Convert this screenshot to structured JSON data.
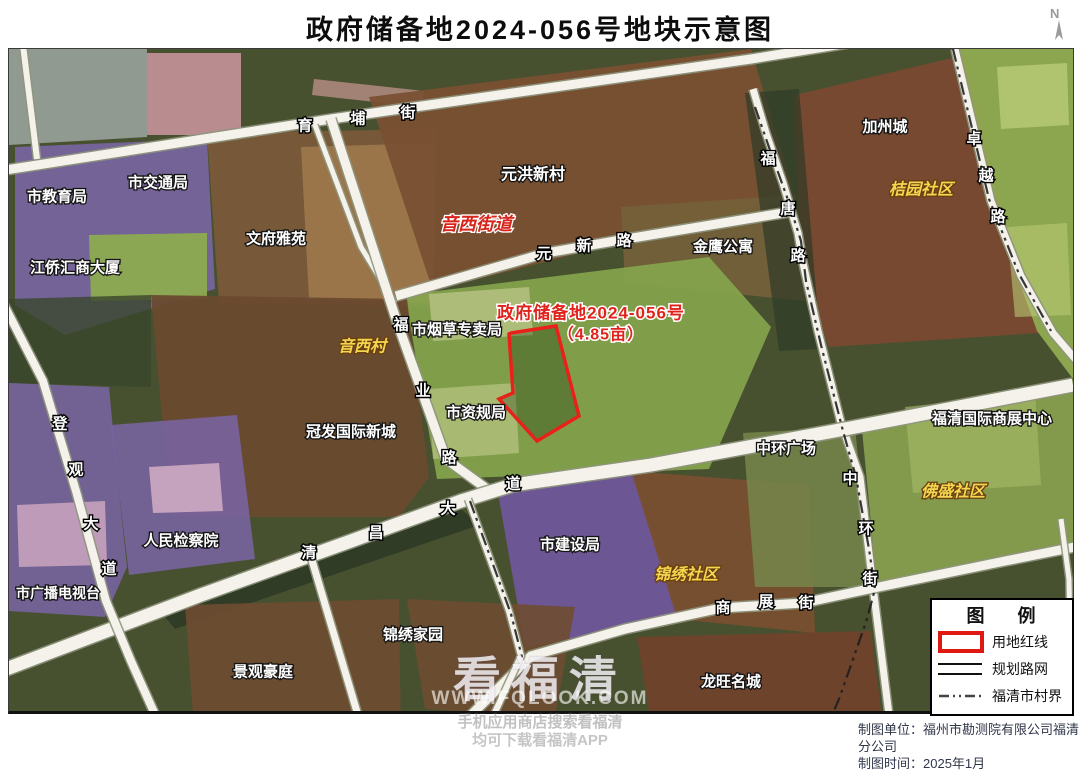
{
  "title": "政府储备地2024-056号地块示意图",
  "north_label": "N",
  "parcel": {
    "name": "政府储备地2024-056号",
    "area_label": "（4.85亩）",
    "area_mu": "4.85",
    "outline_color": "#e8211a"
  },
  "legend": {
    "title": "图 例",
    "items": [
      {
        "type": "red-rect",
        "label": "用地红线"
      },
      {
        "type": "double-line",
        "label": "规划路网"
      },
      {
        "type": "dash-dot",
        "label": "福清市村界"
      }
    ]
  },
  "credits": {
    "unit": "制图单位：福州市勘测院有限公司福清分公司",
    "date": "制图时间：2025年1月"
  },
  "watermark": {
    "brand": "看福清",
    "url": "WWW.FQLOOK.COM",
    "line1": "手机应用商店搜索看福清",
    "line2": "均可下载看福清APP"
  },
  "colors": {
    "road": "#f4f2ea",
    "road_casing": "#8f957e",
    "boundary": "#1c1c1c",
    "parcel_red": "#e8211a",
    "label_white": "#ffffff",
    "label_yellow": "#f4d64f",
    "label_red": "#d8251c",
    "base_green": "#47512f"
  },
  "map": {
    "regions": [
      {
        "name": "topleft-grey",
        "fill": "#99a29b",
        "opacity": 0.9,
        "points": "0,0 138,0 138,88 0,96"
      },
      {
        "name": "track-field",
        "fill": "#c08f96",
        "opacity": 0.95,
        "points": "138,4 232,4 232,86 138,86"
      },
      {
        "name": "pink-strip",
        "fill": "#b98e86",
        "opacity": 0.8,
        "points": "305,30 415,42 412,58 303,46"
      },
      {
        "name": "edu-purple",
        "fill": "#7b65a5",
        "opacity": 0.88,
        "points": "6,98 198,90 206,240 56,286 6,256"
      },
      {
        "name": "edu-green",
        "fill": "#8cab50",
        "opacity": 0.95,
        "points": "80,186 198,184 198,250 82,252"
      },
      {
        "name": "jiaotong-brown",
        "fill": "#7c5a3b",
        "opacity": 0.92,
        "points": "198,84 428,80 424,258 210,254"
      },
      {
        "name": "wenfu-tan",
        "fill": "#a07a4e",
        "opacity": 0.85,
        "points": "292,98 426,94 424,254 300,250"
      },
      {
        "name": "yuanhong-brown",
        "fill": "#7a5033",
        "opacity": 0.95,
        "points": "360,48 742,0 786,148 424,242"
      },
      {
        "name": "jinying-area",
        "fill": "#74603a",
        "opacity": 0.9,
        "points": "612,158 786,146 796,252 616,234"
      },
      {
        "name": "jiazhou-brown",
        "fill": "#7a4931",
        "opacity": 0.95,
        "points": "786,46 956,6 1004,198 1030,284 820,298 790,214"
      },
      {
        "name": "right-green",
        "fill": "#93ad53",
        "opacity": 0.92,
        "points": "950,0 1064,0 1064,330 1028,282 984,158"
      },
      {
        "name": "right-green-light1",
        "fill": "#b9ca75",
        "opacity": 0.8,
        "points": "988,18 1058,14 1060,76 992,80"
      },
      {
        "name": "right-green-light2",
        "fill": "#b9ca75",
        "opacity": 0.6,
        "points": "998,178 1058,174 1062,266 1006,268"
      },
      {
        "name": "center-green",
        "fill": "#86a54d",
        "opacity": 0.92,
        "points": "396,246 700,208 762,278 700,420 428,430"
      },
      {
        "name": "tobacco-building",
        "fill": "#b5c180",
        "opacity": 0.85,
        "points": "420,245 520,238 524,286 424,292"
      },
      {
        "name": "zigui-building",
        "fill": "#b5c180",
        "opacity": 0.75,
        "points": "420,340 506,334 510,404 424,410"
      },
      {
        "name": "yinxi-brown",
        "fill": "#6a4a2f",
        "opacity": 0.95,
        "points": "142,246 398,250 420,428 390,468 162,468"
      },
      {
        "name": "treeband-left",
        "fill": "#3a462c",
        "opacity": 0.8,
        "points": "0,250 142,246 142,338 0,334"
      },
      {
        "name": "treeband-futang",
        "fill": "#2f3b26",
        "opacity": 0.7,
        "points": "736,44 790,40 812,300 770,302"
      },
      {
        "name": "water-strip",
        "fill": "#2d3a25",
        "opacity": 0.9,
        "points": "148,558 452,460 470,476 166,580"
      },
      {
        "name": "broadcast-purple",
        "fill": "#7a64a4",
        "opacity": 0.85,
        "points": "0,334 100,338 108,424 118,518 96,568 0,562"
      },
      {
        "name": "broadcast-building",
        "fill": "#c7a2bc",
        "opacity": 0.9,
        "points": "8,456 96,452 98,516 10,518"
      },
      {
        "name": "procuratorate-purple",
        "fill": "#7a64a4",
        "opacity": 0.85,
        "points": "102,376 228,366 246,510 120,526"
      },
      {
        "name": "procuratorate-bldg",
        "fill": "#c9a6c0",
        "opacity": 0.95,
        "points": "140,418 210,414 214,462 144,464"
      },
      {
        "name": "construction-purple",
        "fill": "#7157a0",
        "opacity": 0.9,
        "points": "488,438 622,418 670,570 516,598"
      },
      {
        "name": "jinxiushequ-brown",
        "fill": "#7a4f30",
        "opacity": 0.9,
        "points": "622,422 800,436 806,584 668,570"
      },
      {
        "name": "zhonghuan-olive",
        "fill": "#76864a",
        "opacity": 0.85,
        "points": "734,384 846,378 862,538 746,538"
      },
      {
        "name": "rightbottom-green",
        "fill": "#89a150",
        "opacity": 0.92,
        "points": "852,370 1064,330 1064,496 868,538"
      },
      {
        "name": "rightbottom-light",
        "fill": "#a7bc67",
        "opacity": 0.6,
        "points": "896,358 1026,344 1032,436 904,444"
      },
      {
        "name": "jingguan-brown",
        "fill": "#6e4c31",
        "opacity": 0.92,
        "points": "176,556 390,550 392,700 186,694"
      },
      {
        "name": "jinxiujiayuan-brown",
        "fill": "#6e4c31",
        "opacity": 0.9,
        "points": "398,550 566,558 546,668 416,660"
      },
      {
        "name": "longwang-brown",
        "fill": "#72422c",
        "opacity": 0.92,
        "points": "628,588 862,582 872,662 640,662"
      }
    ],
    "roads": [
      {
        "name": "yupu-street",
        "width": 9,
        "points": "-10,122 322,70 742,10 840,-6"
      },
      {
        "name": "left-lane",
        "width": 6,
        "points": "14,-4 28,110"
      },
      {
        "name": "wenfu-lane",
        "width": 5,
        "points": "306,76 352,198 386,254"
      },
      {
        "name": "fuye-road",
        "width": 9,
        "points": "322,70 387,270 437,410 478,440"
      },
      {
        "name": "yuanxin-road",
        "width": 9,
        "points": "387,247 537,204 617,190 786,162"
      },
      {
        "name": "futang-zhonghuan",
        "width": 7,
        "points": "744,40 757,84 774,134 789,184 794,214 809,282 832,374 851,428 864,538 874,618 880,666"
      },
      {
        "name": "zhuoyue-road",
        "width": 7,
        "points": "946,0 982,152 1012,227 1044,284 1068,312"
      },
      {
        "name": "qingchang-avenue",
        "width": 13,
        "points": "-8,622 192,546 342,492 452,452 504,436 642,416 836,380 1064,336"
      },
      {
        "name": "shangzhan-street",
        "width": 9,
        "points": "370,710 460,668 522,607 616,580 712,559 794,554 860,540 996,512 1066,498"
      },
      {
        "name": "dengguan-avenue",
        "width": 8,
        "points": "-8,250 34,332 67,442 97,552 122,612 166,710"
      },
      {
        "name": "south-lane",
        "width": 7,
        "points": "302,508 362,710"
      },
      {
        "name": "center-south-lane",
        "width": 6,
        "points": "459,450 500,562 512,607 482,672 462,710"
      },
      {
        "name": "corner-lane",
        "width": 5,
        "points": "1052,470 1060,530 1062,662"
      }
    ],
    "boundaries": [
      {
        "name": "village-boundary-east",
        "points": "746,58 762,104 778,148 792,192 797,232 812,296 834,382 847,428 860,500 866,540 858,570 842,616 830,650 824,664"
      },
      {
        "name": "village-boundary-center",
        "points": "461,452 502,565 514,612"
      },
      {
        "name": "village-boundary-zhuoyue",
        "points": "944,0 980,150 1010,225 1042,282"
      }
    ],
    "road_labels": [
      {
        "road": "育埔街",
        "chars": [
          {
            "c": "育",
            "x": 296,
            "y": 77
          },
          {
            "c": "埔",
            "x": 349,
            "y": 70
          },
          {
            "c": "街",
            "x": 399,
            "y": 64
          }
        ]
      },
      {
        "road": "元新路",
        "chars": [
          {
            "c": "元",
            "x": 535,
            "y": 205
          },
          {
            "c": "新",
            "x": 575,
            "y": 197
          },
          {
            "c": "路",
            "x": 615,
            "y": 192
          }
        ]
      },
      {
        "road": "福业路",
        "chars": [
          {
            "c": "福",
            "x": 392,
            "y": 276
          },
          {
            "c": "业",
            "x": 414,
            "y": 342
          },
          {
            "c": "路",
            "x": 440,
            "y": 409
          }
        ]
      },
      {
        "road": "清昌大道",
        "chars": [
          {
            "c": "清",
            "x": 300,
            "y": 504
          },
          {
            "c": "昌",
            "x": 367,
            "y": 484
          },
          {
            "c": "大",
            "x": 439,
            "y": 460
          },
          {
            "c": "道",
            "x": 504,
            "y": 435
          }
        ]
      },
      {
        "road": "福唐路",
        "chars": [
          {
            "c": "福",
            "x": 759,
            "y": 110
          },
          {
            "c": "唐",
            "x": 779,
            "y": 160
          },
          {
            "c": "路",
            "x": 789,
            "y": 207
          }
        ]
      },
      {
        "road": "卓越路",
        "chars": [
          {
            "c": "卓",
            "x": 965,
            "y": 90
          },
          {
            "c": "越",
            "x": 977,
            "y": 127
          },
          {
            "c": "路",
            "x": 989,
            "y": 168
          }
        ]
      },
      {
        "road": "中环街",
        "chars": [
          {
            "c": "中",
            "x": 841,
            "y": 430
          },
          {
            "c": "环",
            "x": 857,
            "y": 480
          },
          {
            "c": "街",
            "x": 861,
            "y": 530
          }
        ]
      },
      {
        "road": "商展街",
        "chars": [
          {
            "c": "商",
            "x": 714,
            "y": 559
          },
          {
            "c": "展",
            "x": 757,
            "y": 553
          },
          {
            "c": "街",
            "x": 797,
            "y": 554
          }
        ]
      },
      {
        "road": "登观大道",
        "chars": [
          {
            "c": "登",
            "x": 51,
            "y": 375
          },
          {
            "c": "观",
            "x": 67,
            "y": 421
          },
          {
            "c": "大",
            "x": 82,
            "y": 475
          },
          {
            "c": "道",
            "x": 100,
            "y": 520
          }
        ]
      }
    ],
    "place_labels": [
      {
        "t": "市教育局",
        "x": 48,
        "y": 148,
        "cls": "lbl",
        "size": 15
      },
      {
        "t": "市交通局",
        "x": 149,
        "y": 134,
        "cls": "lbl",
        "size": 15
      },
      {
        "t": "文府雅苑",
        "x": 267,
        "y": 190,
        "cls": "lbl",
        "size": 15
      },
      {
        "t": "江侨汇商大厦",
        "x": 66,
        "y": 219,
        "cls": "lbl",
        "size": 15
      },
      {
        "t": "元洪新村",
        "x": 524,
        "y": 126,
        "cls": "lbl",
        "size": 16
      },
      {
        "t": "音西街道",
        "x": 467,
        "y": 175,
        "cls": "rlbl",
        "size": 18
      },
      {
        "t": "金鹰公寓",
        "x": 714,
        "y": 198,
        "cls": "lbl",
        "size": 15
      },
      {
        "t": "加州城",
        "x": 876,
        "y": 78,
        "cls": "lbl",
        "size": 15
      },
      {
        "t": "桔园社区",
        "x": 912,
        "y": 141,
        "cls": "ylbl",
        "size": 16
      },
      {
        "t": "市烟草专卖局",
        "x": 448,
        "y": 281,
        "cls": "lbl",
        "size": 15
      },
      {
        "t": "市资规局",
        "x": 467,
        "y": 364,
        "cls": "lbl",
        "size": 15
      },
      {
        "t": "音西村",
        "x": 353,
        "y": 298,
        "cls": "ylbl",
        "size": 16
      },
      {
        "t": "冠发国际新城",
        "x": 342,
        "y": 383,
        "cls": "lbl",
        "size": 15
      },
      {
        "t": "人民检察院",
        "x": 172,
        "y": 492,
        "cls": "lbl",
        "size": 15
      },
      {
        "t": "市广播电视台",
        "x": 49,
        "y": 544,
        "cls": "lbl",
        "size": 14
      },
      {
        "t": "市建设局",
        "x": 561,
        "y": 496,
        "cls": "lbl",
        "size": 15
      },
      {
        "t": "锦绣社区",
        "x": 677,
        "y": 526,
        "cls": "ylbl",
        "size": 16
      },
      {
        "t": "中环广场",
        "x": 777,
        "y": 400,
        "cls": "lbl",
        "size": 15
      },
      {
        "t": "佛盛社区",
        "x": 944,
        "y": 443,
        "cls": "ylbl",
        "size": 16
      },
      {
        "t": "福清国际商展中心",
        "x": 983,
        "y": 370,
        "cls": "lbl",
        "size": 15
      },
      {
        "t": "景观豪庭",
        "x": 254,
        "y": 623,
        "cls": "lbl",
        "size": 15
      },
      {
        "t": "锦绣家园",
        "x": 404,
        "y": 586,
        "cls": "lbl",
        "size": 15
      },
      {
        "t": "龙旺名城",
        "x": 722,
        "y": 633,
        "cls": "lbl",
        "size": 15
      }
    ],
    "parcel_labels": [
      {
        "t": "政府储备地2024-056号",
        "x": 582,
        "y": 264,
        "cls": "plbl",
        "size": 17
      },
      {
        "t": "（4.85亩）",
        "x": 592,
        "y": 286,
        "cls": "plbl",
        "size": 16
      }
    ],
    "parcel_points": "502,284 547,277 570,367 528,392 490,350 504,344 500,285"
  }
}
